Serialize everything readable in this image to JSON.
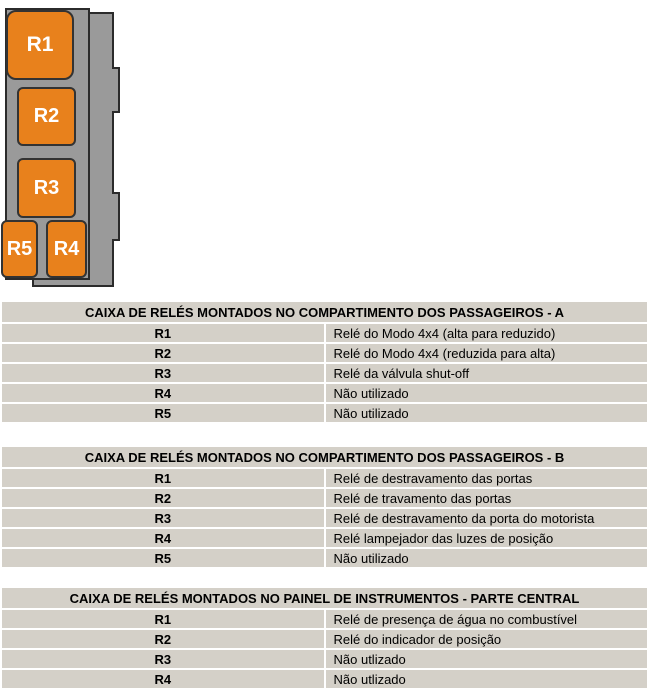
{
  "diagram": {
    "name": "caixa de relés - vista",
    "relays": [
      {
        "id": "R1"
      },
      {
        "id": "R2"
      },
      {
        "id": "R3"
      },
      {
        "id": "R5"
      },
      {
        "id": "R4"
      }
    ],
    "colors": {
      "relay_orange": "#e8811c",
      "panel_gray": "#9a9a9a",
      "outline_dark": "#2b2b2b"
    }
  },
  "tables": [
    {
      "title": "CAIXA DE RELÉS MONTADOS NO COMPARTIMENTO DOS PASSAGEIROS - A",
      "rows": [
        {
          "id": "R1",
          "desc": "Relé do Modo 4x4 (alta para reduzido)"
        },
        {
          "id": "R2",
          "desc": "Relé do Modo 4x4 (reduzida para alta)"
        },
        {
          "id": "R3",
          "desc": "Relé da válvula shut-off"
        },
        {
          "id": "R4",
          "desc": "Não utilizado"
        },
        {
          "id": "R5",
          "desc": "Não utilizado"
        }
      ]
    },
    {
      "title": "CAIXA DE RELÉS MONTADOS NO COMPARTIMENTO DOS PASSAGEIROS - B",
      "rows": [
        {
          "id": "R1",
          "desc": "Relé de destravamento das portas"
        },
        {
          "id": "R2",
          "desc": "Relé de travamento das portas"
        },
        {
          "id": "R3",
          "desc": "Relé de destravamento da porta do motorista"
        },
        {
          "id": "R4",
          "desc": "Relé lampejador das luzes de posição"
        },
        {
          "id": "R5",
          "desc": "Não utilizado"
        }
      ]
    },
    {
      "title": "CAIXA DE RELÉS MONTADOS NO PAINEL DE INSTRUMENTOS - PARTE CENTRAL",
      "rows": [
        {
          "id": "R1",
          "desc": "Relé de presença de água no combustível"
        },
        {
          "id": "R2",
          "desc": "Relé do indicador de posição"
        },
        {
          "id": "R3",
          "desc": "Não utlizado"
        },
        {
          "id": "R4",
          "desc": "Não utlizado"
        }
      ]
    }
  ],
  "colors": {
    "table_cell_gray": "#d4d0c8",
    "row_gap_white": "#ffffff"
  }
}
